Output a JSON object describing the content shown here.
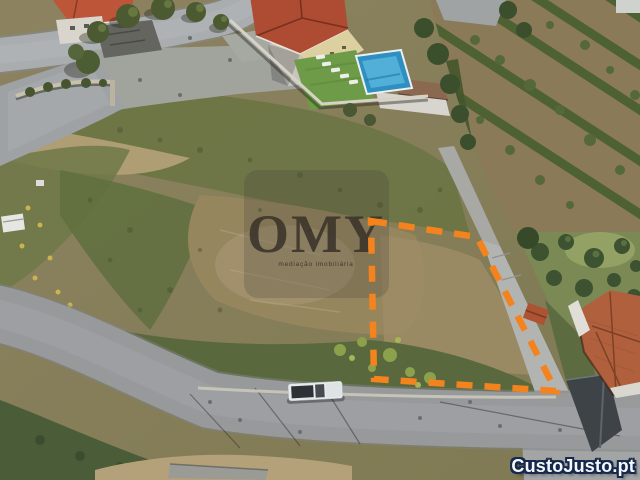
{
  "watermark": {
    "logo_text": "OMY",
    "tagline": "mediação imobiliária"
  },
  "source_watermark": {
    "label": "CustoJusto.pt"
  },
  "colors": {
    "plot_boundary": "#F5831D",
    "pool_water": "#2E8FC0",
    "red_roof": "#AD4B33",
    "terracotta_roof": "#B0603C",
    "road_asphalt": "#97999B",
    "field_brown": "#8B7F5D",
    "scrub_green": "#67713F",
    "source_text": "#FFFFFF",
    "source_outline": "#16294D"
  }
}
